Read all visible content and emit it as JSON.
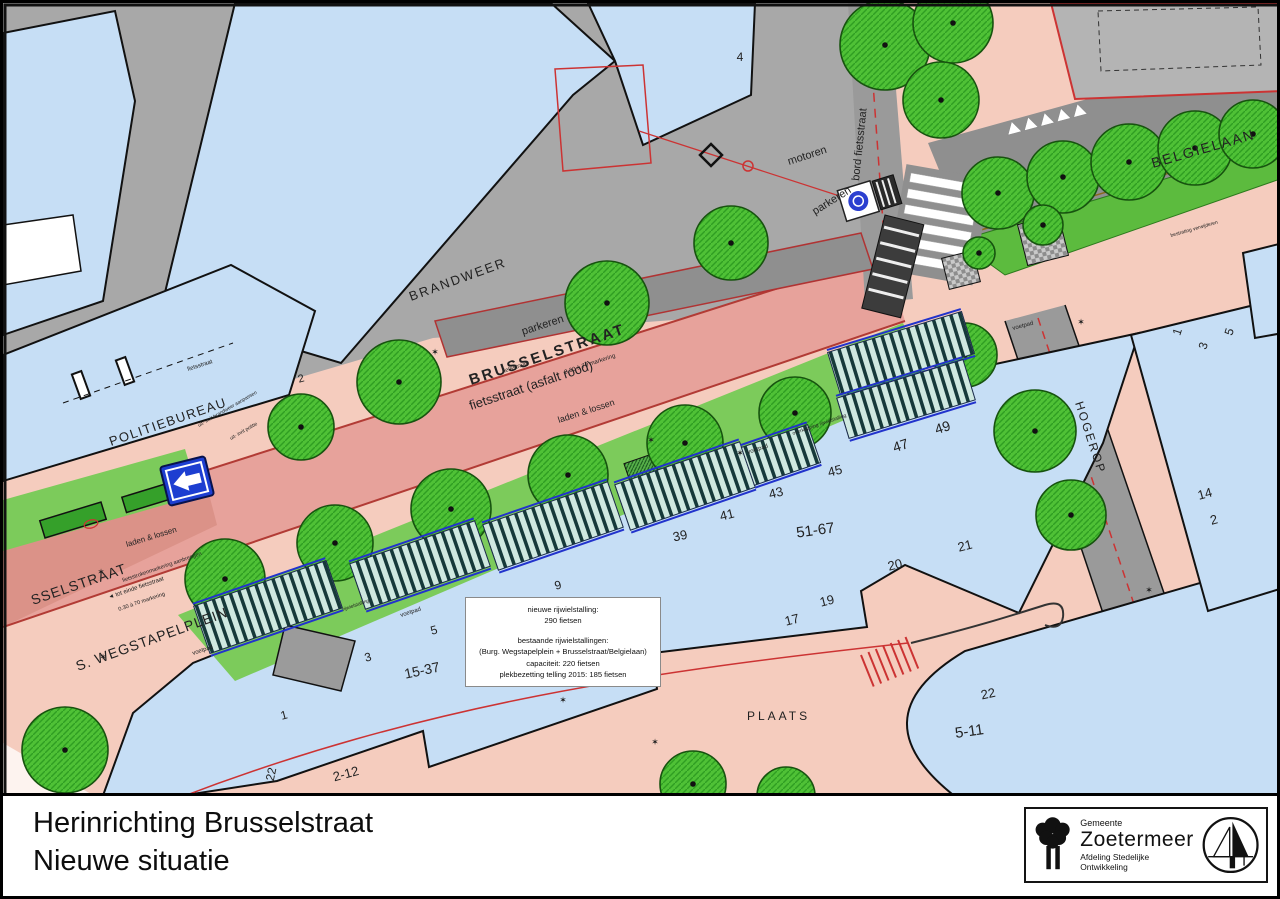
{
  "title_block": {
    "line1": "Herinrichting Brusselstraat",
    "line2": "Nieuwe situatie",
    "logo": {
      "small": "Gemeente",
      "name": "Zoetermeer",
      "dept": "Afdeling Stedelijke Ontwikkeling"
    }
  },
  "info_box": {
    "lines": [
      "nieuwe rijwielstalling:",
      "290 fietsen",
      "bestaande rijwielstallingen:",
      "(Burg. Wegstapelplein + Brusselstraat/Belgielaan)",
      "capaciteit: 220 fietsen",
      "plekbezetting telling 2015: 185 fietsen"
    ]
  },
  "map": {
    "colors": {
      "building_blue": "#c6def5",
      "sidewalk_pink": "#f5ccbe",
      "road_red": "#e7a29b",
      "pavement_gray": "#a8a8a8",
      "tree_green": "#4fc136",
      "number_red": "#d04a63",
      "line_red": "#c23430",
      "rack_blue": "#2233cc"
    },
    "labels": [
      {
        "t": "BRANDWEER",
        "x": 408,
        "y": 298,
        "r": -20,
        "s": 13,
        "ls": 2
      },
      {
        "t": "POLITIEBUREAU",
        "x": 108,
        "y": 443,
        "r": -19,
        "s": 13,
        "ls": 1.5
      },
      {
        "t": "BELGIELAAN",
        "x": 1150,
        "y": 165,
        "r": -16,
        "s": 14,
        "ls": 2
      },
      {
        "t": "HOGEROP",
        "x": 1072,
        "y": 400,
        "r": 72,
        "s": 12,
        "ls": 2
      },
      {
        "t": "PLAATS",
        "x": 744,
        "y": 717,
        "r": 0,
        "s": 12,
        "ls": 3
      },
      {
        "t": "S. WEGSTAPELPLEIN",
        "x": 75,
        "y": 668,
        "r": -20,
        "s": 14,
        "ls": 1
      },
      {
        "t": "SSELSTRAAT",
        "x": 30,
        "y": 602,
        "r": -19,
        "s": 14,
        "ls": 1
      },
      {
        "t": "BRUSSELSTRAAT",
        "x": 468,
        "y": 382,
        "r": -18.5,
        "s": 15,
        "ls": 2.5,
        "w": 600
      },
      {
        "t": "fietsstraat (asfalt rood)",
        "x": 468,
        "y": 407,
        "r": -18.5,
        "s": 13
      },
      {
        "t": "0.30 à 70 markering",
        "x": 562,
        "y": 371,
        "r": -18.5,
        "s": 6,
        "c": "#333"
      },
      {
        "t": "parkeren",
        "x": 520,
        "y": 332,
        "r": -18,
        "s": 11
      },
      {
        "t": "parkeren",
        "x": 812,
        "y": 212,
        "r": -32,
        "s": 11
      },
      {
        "t": "motoren",
        "x": 786,
        "y": 162,
        "r": -18,
        "s": 11
      },
      {
        "t": "bord fietsstraat",
        "x": 856,
        "y": 178,
        "r": -84,
        "s": 11
      },
      {
        "t": "laden & lossen",
        "x": 556,
        "y": 420,
        "r": -18,
        "s": 9
      },
      {
        "t": "laden & lossen",
        "x": 124,
        "y": 544,
        "r": -17,
        "s": 8
      },
      {
        "t": "voetpad",
        "x": 190,
        "y": 652,
        "r": -18,
        "s": 6
      },
      {
        "t": "voetpad",
        "x": 398,
        "y": 614,
        "r": -18,
        "s": 6
      },
      {
        "t": "voetpad",
        "x": 745,
        "y": 451,
        "r": -18,
        "s": 6
      },
      {
        "t": "voetpad",
        "x": 1010,
        "y": 327,
        "r": -15,
        "s": 6
      },
      {
        "t": "fietsstraat",
        "x": 500,
        "y": 370,
        "r": -18,
        "s": 6
      },
      {
        "t": "fietsstraat",
        "x": 185,
        "y": 368,
        "r": -18,
        "s": 6
      },
      {
        "t": "uit- inrit brandweer aanpassen",
        "x": 196,
        "y": 424,
        "r": -30,
        "s": 5
      },
      {
        "t": "uit- inrit politie",
        "x": 228,
        "y": 437,
        "r": -30,
        "s": 5
      },
      {
        "t": "fietsstrokenmarkering aanbrengen",
        "x": 120,
        "y": 579,
        "r": -19,
        "s": 5.5,
        "c": "#b03333"
      },
      {
        "t": "◄ tot einde fietsstraat",
        "x": 106,
        "y": 596,
        "r": -19,
        "s": 6
      },
      {
        "t": "0.30 à 70 markering",
        "x": 116,
        "y": 608,
        "r": -19,
        "s": 5.5
      },
      {
        "t": "rijwielstalling",
        "x": 340,
        "y": 608,
        "r": -19,
        "s": 5,
        "c": "#223"
      },
      {
        "t": "overkapping rijwielstalling",
        "x": 790,
        "y": 432,
        "r": -19,
        "s": 5,
        "c": "#223"
      },
      {
        "t": "bestrating verwijderen",
        "x": 1168,
        "y": 234,
        "r": -16,
        "s": 5,
        "c": "#b03333"
      }
    ],
    "house_numbers": [
      {
        "t": "4",
        "x": 737,
        "y": 58,
        "r": 0,
        "s": 12
      },
      {
        "t": "2",
        "x": 299,
        "y": 379,
        "r": -15,
        "s": 11
      },
      {
        "t": "1",
        "x": 1178,
        "y": 330,
        "r": -72,
        "s": 12
      },
      {
        "t": "3",
        "x": 1204,
        "y": 344,
        "r": -72,
        "s": 12
      },
      {
        "t": "5",
        "x": 1230,
        "y": 330,
        "r": -72,
        "s": 12
      },
      {
        "t": "14",
        "x": 1203,
        "y": 495,
        "r": -15,
        "s": 13
      },
      {
        "t": "2",
        "x": 1212,
        "y": 521,
        "r": -15,
        "s": 13
      },
      {
        "t": "1",
        "x": 282,
        "y": 716,
        "r": -15,
        "s": 12
      },
      {
        "t": "22",
        "x": 272,
        "y": 772,
        "r": -78,
        "s": 12
      },
      {
        "t": "2-12",
        "x": 344,
        "y": 775,
        "r": -15,
        "s": 13
      },
      {
        "t": "15-37",
        "x": 420,
        "y": 672,
        "r": -12,
        "s": 14
      },
      {
        "t": "3",
        "x": 366,
        "y": 658,
        "r": -15,
        "s": 12
      },
      {
        "t": "5",
        "x": 432,
        "y": 631,
        "r": -15,
        "s": 12
      },
      {
        "t": "7",
        "x": 493,
        "y": 608,
        "r": -15,
        "s": 12
      },
      {
        "t": "9",
        "x": 556,
        "y": 586,
        "r": -15,
        "s": 12
      },
      {
        "t": "39",
        "x": 678,
        "y": 537,
        "r": -12,
        "s": 13
      },
      {
        "t": "41",
        "x": 725,
        "y": 516,
        "r": -14,
        "s": 13
      },
      {
        "t": "43",
        "x": 774,
        "y": 494,
        "r": -14,
        "s": 13
      },
      {
        "t": "45",
        "x": 833,
        "y": 472,
        "r": -14,
        "s": 13
      },
      {
        "t": "47",
        "x": 899,
        "y": 447,
        "r": -18,
        "s": 14
      },
      {
        "t": "49",
        "x": 941,
        "y": 429,
        "r": -18,
        "s": 14
      },
      {
        "t": "51-67",
        "x": 813,
        "y": 532,
        "r": -8,
        "s": 15
      },
      {
        "t": "17",
        "x": 790,
        "y": 621,
        "r": -14,
        "s": 13
      },
      {
        "t": "19",
        "x": 825,
        "y": 602,
        "r": -14,
        "s": 13
      },
      {
        "t": "20",
        "x": 893,
        "y": 566,
        "r": -14,
        "s": 13
      },
      {
        "t": "21",
        "x": 963,
        "y": 547,
        "r": -14,
        "s": 13
      },
      {
        "t": "22",
        "x": 986,
        "y": 695,
        "r": -12,
        "s": 13
      },
      {
        "t": "5-11",
        "x": 967,
        "y": 733,
        "r": -8,
        "s": 15
      }
    ],
    "trees": [
      [
        882,
        42,
        45
      ],
      [
        950,
        20,
        40
      ],
      [
        938,
        97,
        38
      ],
      [
        728,
        240,
        37
      ],
      [
        604,
        300,
        42
      ],
      [
        396,
        379,
        42
      ],
      [
        298,
        424,
        33
      ],
      [
        222,
        576,
        40
      ],
      [
        332,
        540,
        38
      ],
      [
        448,
        506,
        40
      ],
      [
        565,
        472,
        40
      ],
      [
        682,
        440,
        38
      ],
      [
        792,
        410,
        36
      ],
      [
        882,
        382,
        38
      ],
      [
        962,
        352,
        32
      ],
      [
        995,
        190,
        36
      ],
      [
        1060,
        174,
        36
      ],
      [
        1126,
        159,
        38
      ],
      [
        1192,
        145,
        37
      ],
      [
        1250,
        131,
        34
      ],
      [
        1032,
        428,
        41
      ],
      [
        1068,
        512,
        35
      ],
      [
        62,
        747,
        43
      ],
      [
        690,
        781,
        33
      ],
      [
        783,
        793,
        29
      ],
      [
        1040,
        222,
        20
      ],
      [
        976,
        250,
        16
      ]
    ],
    "racks": [
      [
        265,
        604,
        140,
        50,
        -19
      ],
      [
        417,
        562,
        132,
        48,
        -19
      ],
      [
        550,
        523,
        132,
        48,
        -19
      ],
      [
        682,
        483,
        132,
        48,
        -19
      ],
      [
        778,
        452,
        70,
        40,
        -19
      ],
      [
        898,
        350,
        140,
        44,
        -17
      ],
      [
        903,
        396,
        132,
        42,
        -17
      ]
    ],
    "symbols": [
      [
        432,
        352
      ],
      [
        100,
        657
      ],
      [
        648,
        440
      ],
      [
        737,
        453
      ],
      [
        1078,
        322
      ],
      [
        98,
        572
      ],
      [
        560,
        700
      ],
      [
        1146,
        590
      ],
      [
        652,
        742
      ]
    ]
  }
}
